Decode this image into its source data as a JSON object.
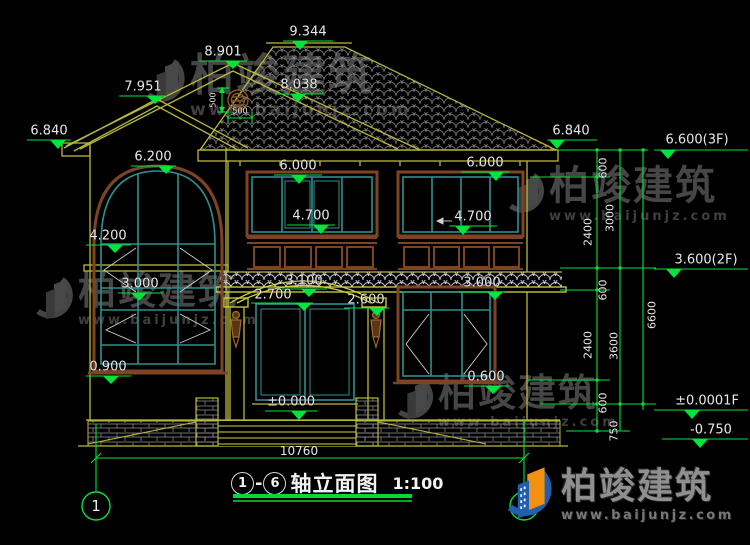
{
  "page": {
    "background": "#000000",
    "dim_color": "#00e43c",
    "wall_color": "#b9b93a",
    "frame_color": "#7c4424",
    "window_color": "#2f8f8f",
    "text_color": "#e8e8e8"
  },
  "title_block": {
    "axis_start": "1",
    "dash": "-",
    "axis_end": "6",
    "title": "轴立面图",
    "scale": "1:100"
  },
  "axes": {
    "left": "1",
    "right": "6"
  },
  "watermark": {
    "name": "柏竣建筑",
    "url": "www.baijunjz.com"
  },
  "brand": {
    "name": "柏竣建筑",
    "url": "www.baijunjz.com"
  },
  "annotations": [
    {
      "id": "level-9344",
      "text": "9.344",
      "x": 308,
      "y": 32,
      "size": 13
    },
    {
      "id": "level-8901",
      "text": "8.901",
      "x": 223,
      "y": 52,
      "size": 13
    },
    {
      "id": "level-7951",
      "text": "7.951",
      "x": 143,
      "y": 87,
      "size": 13
    },
    {
      "id": "level-8038",
      "text": "8.038",
      "x": 299,
      "y": 85,
      "size": 13
    },
    {
      "id": "level-6840-left",
      "text": "6.840",
      "x": 49,
      "y": 131,
      "size": 13
    },
    {
      "id": "level-6840-right",
      "text": "6.840",
      "x": 571,
      "y": 131,
      "size": 13
    },
    {
      "id": "level-6600-3f",
      "text": "6.600(3F)",
      "x": 697,
      "y": 140,
      "size": 13
    },
    {
      "id": "level-6200",
      "text": "6.200",
      "x": 153,
      "y": 157,
      "size": 13
    },
    {
      "id": "level-6000-center",
      "text": "6.000",
      "x": 298,
      "y": 166,
      "size": 13
    },
    {
      "id": "level-6000-right",
      "text": "6.000",
      "x": 485,
      "y": 163,
      "size": 13
    },
    {
      "id": "level-4700-center",
      "text": "4.700",
      "x": 311,
      "y": 216,
      "size": 13
    },
    {
      "id": "level-4700-right",
      "text": "4.700",
      "x": 473,
      "y": 217,
      "size": 13
    },
    {
      "id": "level-4200",
      "text": "4.200",
      "x": 108,
      "y": 236,
      "size": 13
    },
    {
      "id": "level-3000-left",
      "text": "3.000",
      "x": 140,
      "y": 284,
      "size": 13
    },
    {
      "id": "level-3100",
      "text": "3.100",
      "x": 304,
      "y": 281,
      "size": 13
    },
    {
      "id": "level-2700",
      "text": "2.700",
      "x": 273,
      "y": 295,
      "size": 13
    },
    {
      "id": "level-2600",
      "text": "2.600",
      "x": 366,
      "y": 300,
      "size": 13
    },
    {
      "id": "level-3600-2f",
      "text": "3.600(2F)",
      "x": 706,
      "y": 260,
      "size": 13
    },
    {
      "id": "level-3000-right",
      "text": "3.000",
      "x": 482,
      "y": 283,
      "size": 13
    },
    {
      "id": "level-0900",
      "text": "0.900",
      "x": 108,
      "y": 367,
      "size": 13
    },
    {
      "id": "level-0600",
      "text": "0.600",
      "x": 486,
      "y": 377,
      "size": 13
    },
    {
      "id": "level-zero",
      "text": "±0.000",
      "x": 291,
      "y": 402,
      "size": 13
    },
    {
      "id": "level-zero-1f",
      "text": "±0.0001F",
      "x": 707,
      "y": 401,
      "size": 13
    },
    {
      "id": "level-minus-0750",
      "text": "-0.750",
      "x": 711,
      "y": 430,
      "size": 13
    },
    {
      "id": "dim-10760",
      "text": "10760",
      "x": 299,
      "y": 451,
      "size": 12
    },
    {
      "id": "dim-500-v",
      "text": "500",
      "x": 213,
      "y": 100,
      "size": 8,
      "rot": true
    },
    {
      "id": "dim-500-h",
      "text": "500",
      "x": 240,
      "y": 111,
      "size": 8
    },
    {
      "id": "dim-600-top",
      "text": "600",
      "x": 603,
      "y": 168,
      "size": 11,
      "rot": true
    },
    {
      "id": "dim-2400-top",
      "text": "2400",
      "x": 588,
      "y": 232,
      "size": 11,
      "rot": true
    },
    {
      "id": "dim-3000-chain",
      "text": "3000",
      "x": 610,
      "y": 218,
      "size": 11,
      "rot": true
    },
    {
      "id": "dim-600-mid",
      "text": "600",
      "x": 603,
      "y": 290,
      "size": 11,
      "rot": true
    },
    {
      "id": "dim-2400-bottom",
      "text": "2400",
      "x": 588,
      "y": 345,
      "size": 11,
      "rot": true
    },
    {
      "id": "dim-3600-chain",
      "text": "3600",
      "x": 614,
      "y": 346,
      "size": 11,
      "rot": true
    },
    {
      "id": "dim-600-bottom",
      "text": "600",
      "x": 603,
      "y": 403,
      "size": 11,
      "rot": true
    },
    {
      "id": "dim-750",
      "text": "750",
      "x": 614,
      "y": 431,
      "size": 11,
      "rot": true
    },
    {
      "id": "dim-6600-chain",
      "text": "6600",
      "x": 652,
      "y": 315,
      "size": 11,
      "rot": true
    }
  ]
}
